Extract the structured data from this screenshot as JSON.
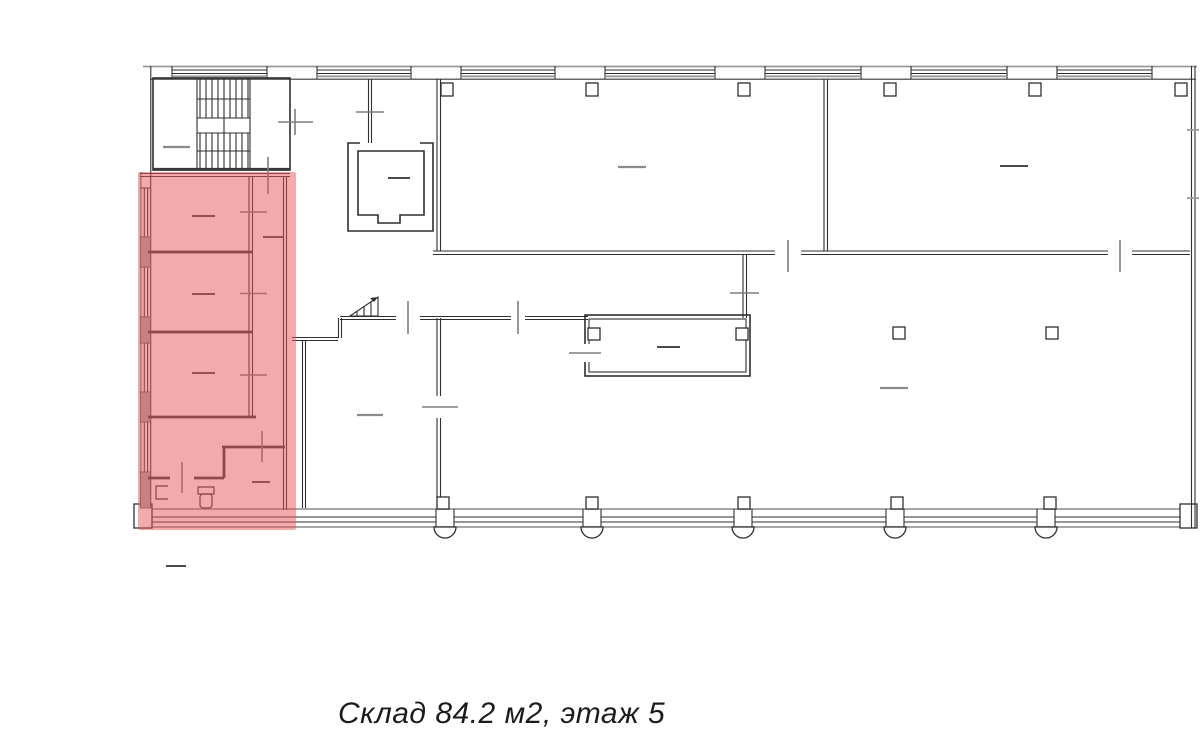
{
  "page": {
    "width": 1200,
    "height": 745,
    "background": "#ffffff"
  },
  "floorplan": {
    "name": "building-floor-plan",
    "wall_color": "#2f2f2f",
    "secondary_line_color": "#9a9a9a",
    "highlight": {
      "color": "#e85555",
      "opacity": "0.5"
    }
  },
  "caption": {
    "text": "Склад 84.2 м2, этаж 5",
    "unit_type": "Склад",
    "area": "84.2 м2",
    "floor": "этаж 5",
    "color": "#1c1c1c"
  }
}
